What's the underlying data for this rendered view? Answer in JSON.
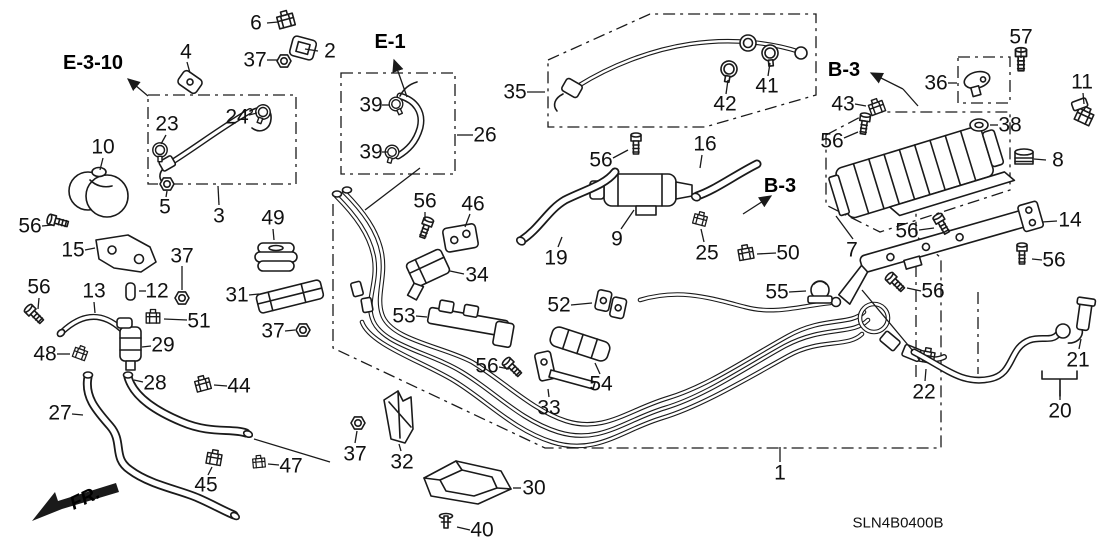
{
  "diagram": {
    "code": "SLN4B0400B",
    "fr_label": "FR.",
    "colors": {
      "background": "#ffffff",
      "line": "#1a1a1a"
    },
    "ref_labels": [
      {
        "text": "E-3-10",
        "x": 93,
        "y": 63,
        "arrow": [
          148,
          96,
          128,
          79
        ]
      },
      {
        "text": "E-1",
        "x": 390,
        "y": 42,
        "arrow": [
          407,
          97,
          394,
          60
        ]
      },
      {
        "text": "B-3",
        "x": 844,
        "y": 70,
        "arrow": [
          903,
          89,
          871,
          73
        ]
      },
      {
        "text": "B-3",
        "x": 780,
        "y": 186,
        "arrow": [
          743,
          214,
          771,
          196
        ]
      }
    ],
    "part_labels": [
      {
        "text": "1",
        "x": 780,
        "y": 473,
        "leader": [
          780,
          462,
          780,
          447
        ]
      },
      {
        "text": "2",
        "x": 330,
        "y": 51,
        "leader": [
          318,
          51,
          305,
          49
        ]
      },
      {
        "text": "3",
        "x": 219,
        "y": 216,
        "leader": [
          219,
          205,
          218,
          186
        ]
      },
      {
        "text": "4",
        "x": 186,
        "y": 52,
        "leader": [
          187,
          62,
          190,
          73
        ]
      },
      {
        "text": "5",
        "x": 165,
        "y": 207,
        "leader": [
          166,
          197,
          167,
          191
        ]
      },
      {
        "text": "6",
        "x": 256,
        "y": 23,
        "leader": [
          267,
          23,
          278,
          22
        ]
      },
      {
        "text": "7",
        "x": 852,
        "y": 250,
        "leader": [
          853,
          239,
          836,
          216
        ]
      },
      {
        "text": "8",
        "x": 1058,
        "y": 160,
        "leader": [
          1046,
          160,
          1034,
          159
        ]
      },
      {
        "text": "9",
        "x": 617,
        "y": 239,
        "leader": [
          621,
          229,
          634,
          210
        ]
      },
      {
        "text": "10",
        "x": 103,
        "y": 147,
        "leader": [
          103,
          158,
          100,
          170
        ]
      },
      {
        "text": "11",
        "x": 1082,
        "y": 82,
        "leader": [
          1083,
          93,
          1084,
          104
        ]
      },
      {
        "text": "12",
        "x": 157,
        "y": 291,
        "leader": [
          146,
          291,
          139,
          291
        ]
      },
      {
        "text": "13",
        "x": 94,
        "y": 291,
        "leader": [
          94,
          302,
          95,
          313
        ]
      },
      {
        "text": "14",
        "x": 1070,
        "y": 220,
        "leader": [
          1057,
          221,
          1042,
          222
        ]
      },
      {
        "text": "15",
        "x": 73,
        "y": 250,
        "leader": [
          85,
          250,
          95,
          248
        ]
      },
      {
        "text": "16",
        "x": 705,
        "y": 144,
        "leader": [
          702,
          155,
          700,
          168
        ]
      },
      {
        "text": "19",
        "x": 556,
        "y": 258,
        "leader": [
          558,
          247,
          562,
          237
        ]
      },
      {
        "text": "20",
        "x": 1060,
        "y": 411,
        "leader": [
          1060,
          400,
          1060,
          390
        ]
      },
      {
        "text": "21",
        "x": 1078,
        "y": 360,
        "leader": [
          1079,
          349,
          1081,
          339
        ]
      },
      {
        "text": "22",
        "x": 924,
        "y": 392,
        "leader": [
          925,
          381,
          926,
          369
        ]
      },
      {
        "text": "23",
        "x": 167,
        "y": 124,
        "leader": [
          166,
          135,
          161,
          144
        ]
      },
      {
        "text": "24",
        "x": 237,
        "y": 117,
        "leader": [
          249,
          115,
          257,
          113
        ]
      },
      {
        "text": "25",
        "x": 707,
        "y": 253,
        "leader": [
          704,
          242,
          701,
          229
        ]
      },
      {
        "text": "26",
        "x": 485,
        "y": 135,
        "leader": [
          473,
          135,
          457,
          135
        ]
      },
      {
        "text": "27",
        "x": 60,
        "y": 413,
        "leader": [
          72,
          414,
          83,
          415
        ]
      },
      {
        "text": "28",
        "x": 155,
        "y": 383,
        "leader": [
          143,
          382,
          134,
          380
        ]
      },
      {
        "text": "29",
        "x": 163,
        "y": 345,
        "leader": [
          151,
          346,
          142,
          347
        ]
      },
      {
        "text": "30",
        "x": 534,
        "y": 488,
        "leader": [
          521,
          488,
          513,
          488
        ]
      },
      {
        "text": "31",
        "x": 237,
        "y": 295,
        "leader": [
          249,
          295,
          259,
          294
        ]
      },
      {
        "text": "32",
        "x": 402,
        "y": 462,
        "leader": [
          401,
          451,
          399,
          444
        ]
      },
      {
        "text": "33",
        "x": 549,
        "y": 408,
        "leader": [
          549,
          397,
          548,
          389
        ]
      },
      {
        "text": "34",
        "x": 477,
        "y": 275,
        "leader": [
          464,
          274,
          450,
          271
        ]
      },
      {
        "text": "35",
        "x": 515,
        "y": 92,
        "leader": [
          527,
          92,
          545,
          92
        ]
      },
      {
        "text": "36",
        "x": 936,
        "y": 83,
        "leader": [
          948,
          83,
          957,
          83
        ]
      },
      {
        "text": "37",
        "x": 255,
        "y": 60,
        "leader": [
          267,
          60,
          277,
          60
        ]
      },
      {
        "text": "37",
        "x": 182,
        "y": 256,
        "leader": [
          182,
          266,
          182,
          290
        ]
      },
      {
        "text": "37",
        "x": 273,
        "y": 331,
        "leader": [
          285,
          331,
          295,
          330
        ]
      },
      {
        "text": "37",
        "x": 355,
        "y": 454,
        "leader": [
          355,
          443,
          357,
          431
        ]
      },
      {
        "text": "38",
        "x": 1010,
        "y": 125,
        "leader": [
          998,
          125,
          990,
          125
        ]
      },
      {
        "text": "39",
        "x": 371,
        "y": 105,
        "leader": [
          382,
          105,
          389,
          105
        ]
      },
      {
        "text": "39",
        "x": 371,
        "y": 152,
        "leader": [
          382,
          152,
          388,
          152
        ]
      },
      {
        "text": "40",
        "x": 482,
        "y": 530,
        "leader": [
          470,
          530,
          457,
          527
        ]
      },
      {
        "text": "41",
        "x": 767,
        "y": 86,
        "leader": [
          768,
          76,
          770,
          63
        ]
      },
      {
        "text": "42",
        "x": 725,
        "y": 104,
        "leader": [
          726,
          94,
          728,
          80
        ]
      },
      {
        "text": "43",
        "x": 843,
        "y": 104,
        "leader": [
          855,
          104,
          866,
          106
        ]
      },
      {
        "text": "44",
        "x": 239,
        "y": 386,
        "leader": [
          227,
          386,
          214,
          385
        ]
      },
      {
        "text": "45",
        "x": 206,
        "y": 485,
        "leader": [
          208,
          475,
          212,
          467
        ]
      },
      {
        "text": "46",
        "x": 473,
        "y": 204,
        "leader": [
          470,
          214,
          465,
          227
        ]
      },
      {
        "text": "47",
        "x": 291,
        "y": 466,
        "leader": [
          279,
          465,
          268,
          464
        ]
      },
      {
        "text": "48",
        "x": 45,
        "y": 354,
        "leader": [
          57,
          354,
          70,
          354
        ]
      },
      {
        "text": "49",
        "x": 273,
        "y": 218,
        "leader": [
          273,
          229,
          274,
          240
        ]
      },
      {
        "text": "50",
        "x": 788,
        "y": 253,
        "leader": [
          776,
          253,
          757,
          254
        ]
      },
      {
        "text": "51",
        "x": 199,
        "y": 321,
        "leader": [
          187,
          320,
          164,
          319
        ]
      },
      {
        "text": "52",
        "x": 559,
        "y": 305,
        "leader": [
          571,
          305,
          592,
          303
        ]
      },
      {
        "text": "53",
        "x": 404,
        "y": 316,
        "leader": [
          416,
          316,
          427,
          317
        ]
      },
      {
        "text": "54",
        "x": 601,
        "y": 384,
        "leader": [
          600,
          374,
          595,
          363
        ]
      },
      {
        "text": "55",
        "x": 777,
        "y": 292,
        "leader": [
          789,
          292,
          806,
          291
        ]
      },
      {
        "text": "56",
        "x": 30,
        "y": 226,
        "leader": [
          42,
          226,
          52,
          225
        ]
      },
      {
        "text": "56",
        "x": 39,
        "y": 287,
        "leader": [
          39,
          298,
          38,
          309
        ]
      },
      {
        "text": "56",
        "x": 425,
        "y": 201,
        "leader": [
          425,
          212,
          425,
          221
        ]
      },
      {
        "text": "56",
        "x": 487,
        "y": 366,
        "leader": [
          499,
          367,
          509,
          369
        ]
      },
      {
        "text": "56",
        "x": 601,
        "y": 160,
        "leader": [
          613,
          158,
          628,
          150
        ]
      },
      {
        "text": "56",
        "x": 832,
        "y": 141,
        "leader": [
          844,
          138,
          858,
          132
        ]
      },
      {
        "text": "56",
        "x": 907,
        "y": 231,
        "leader": [
          919,
          230,
          934,
          228
        ]
      },
      {
        "text": "56",
        "x": 933,
        "y": 291,
        "leader": [
          921,
          291,
          907,
          288
        ]
      },
      {
        "text": "56",
        "x": 1054,
        "y": 260,
        "leader": [
          1042,
          260,
          1032,
          259
        ]
      },
      {
        "text": "57",
        "x": 1021,
        "y": 37,
        "leader": [
          1021,
          48,
          1021,
          58
        ]
      }
    ]
  }
}
